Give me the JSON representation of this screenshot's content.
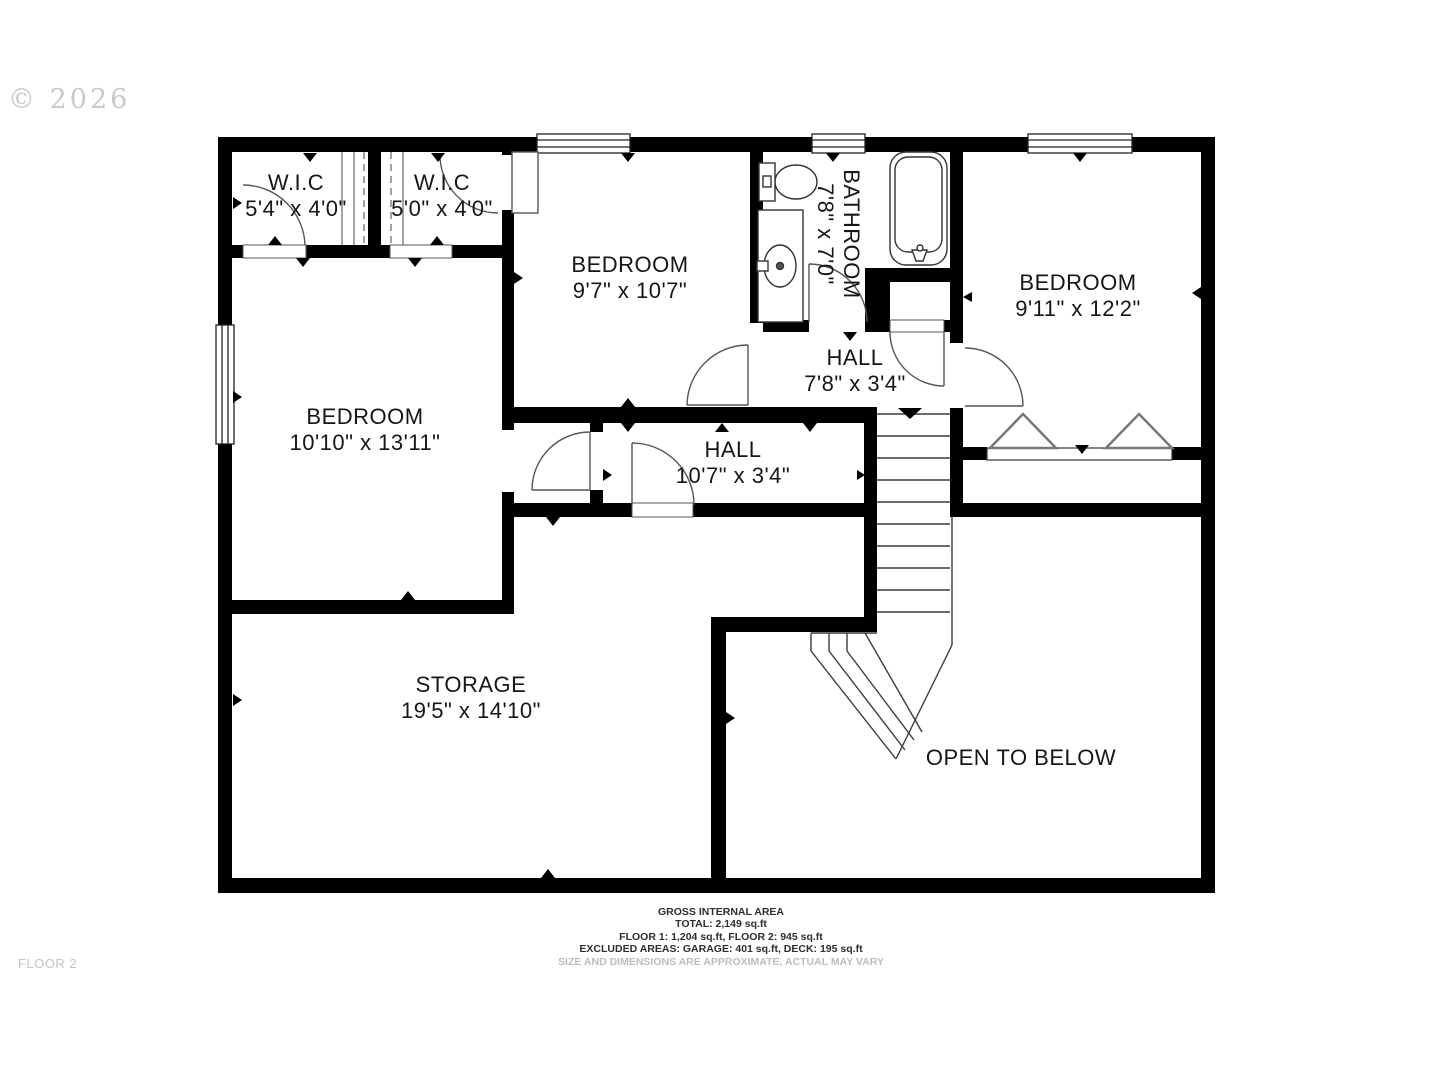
{
  "meta": {
    "watermark": "© 2026",
    "floor_label": "FLOOR 2"
  },
  "rooms": [
    {
      "id": "wic-1",
      "name": "W.I.C",
      "dims": "5'4\" x 4'0\""
    },
    {
      "id": "wic-2",
      "name": "W.I.C",
      "dims": "5'0\" x 4'0\""
    },
    {
      "id": "bedroom-1",
      "name": "BEDROOM",
      "dims": "9'7\" x 10'7\""
    },
    {
      "id": "bathroom",
      "name": "BATHROOM",
      "dims": "7'8\" x 7'0\""
    },
    {
      "id": "bedroom-2",
      "name": "BEDROOM",
      "dims": "9'11\" x 12'2\""
    },
    {
      "id": "bedroom-3",
      "name": "BEDROOM",
      "dims": "10'10\" x 13'11\""
    },
    {
      "id": "hall-1",
      "name": "HALL",
      "dims": "7'8\" x 3'4\""
    },
    {
      "id": "hall-2",
      "name": "HALL",
      "dims": "10'7\" x 3'4\""
    },
    {
      "id": "storage",
      "name": "STORAGE",
      "dims": "19'5\" x 14'10\""
    },
    {
      "id": "open-below",
      "name": "OPEN TO BELOW",
      "dims": ""
    }
  ],
  "footer": {
    "line1": "GROSS INTERNAL AREA",
    "line2": "TOTAL: 2,149 sq.ft",
    "line3": "FLOOR 1: 1,204 sq.ft, FLOOR 2: 945 sq.ft",
    "line4": "EXCLUDED AREAS: GARAGE: 401 sq.ft, DECK: 195 sq.ft",
    "disclaimer": "SIZE AND DIMENSIONS ARE APPROXIMATE, ACTUAL MAY VARY"
  },
  "colors": {
    "wall": "#000000",
    "thin_line": "#3c3c3c",
    "label_text": "#161616",
    "muted_text": "#c4c4c4",
    "hanger_stroke": "#777777"
  }
}
